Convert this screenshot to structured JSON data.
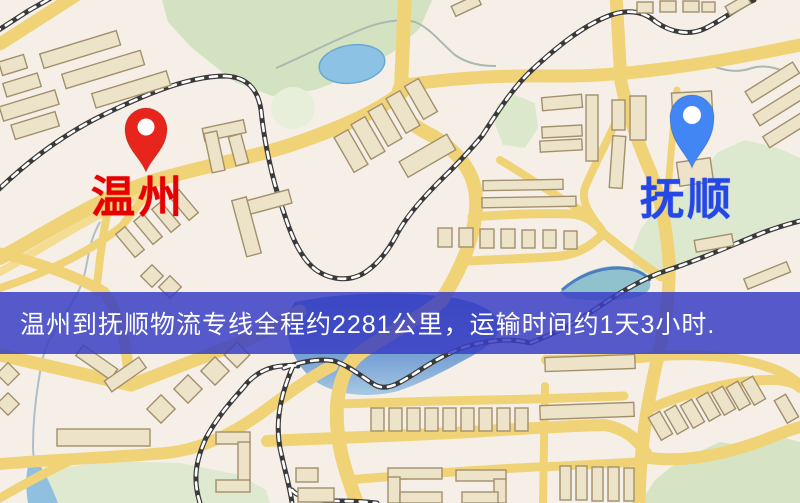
{
  "map": {
    "origin": {
      "label": "温州"
    },
    "destination": {
      "label": "抚顺"
    },
    "banner": {
      "text": "温州到抚顺物流专线全程约2281公里，运输时间约1天3小时."
    },
    "colors": {
      "land": "#f6efe8",
      "road_main": "#f1d377",
      "road_minor": "#f4dc92",
      "railway": "#3a3a3a",
      "water_deep": "#4a7ac6",
      "water_light": "#a6c8e2",
      "pond": "#8cc2e4",
      "park": "#d6e4c4",
      "building_fill": "#ece3c8",
      "building_stroke": "#a2906c",
      "origin_pin": "#e8251c",
      "origin_label": "#e60000",
      "destination_pin": "#4285f4",
      "destination_label": "#2447e6",
      "banner_bg": "rgba(58,62,195,0.85)",
      "banner_text": "#ffffff"
    }
  }
}
